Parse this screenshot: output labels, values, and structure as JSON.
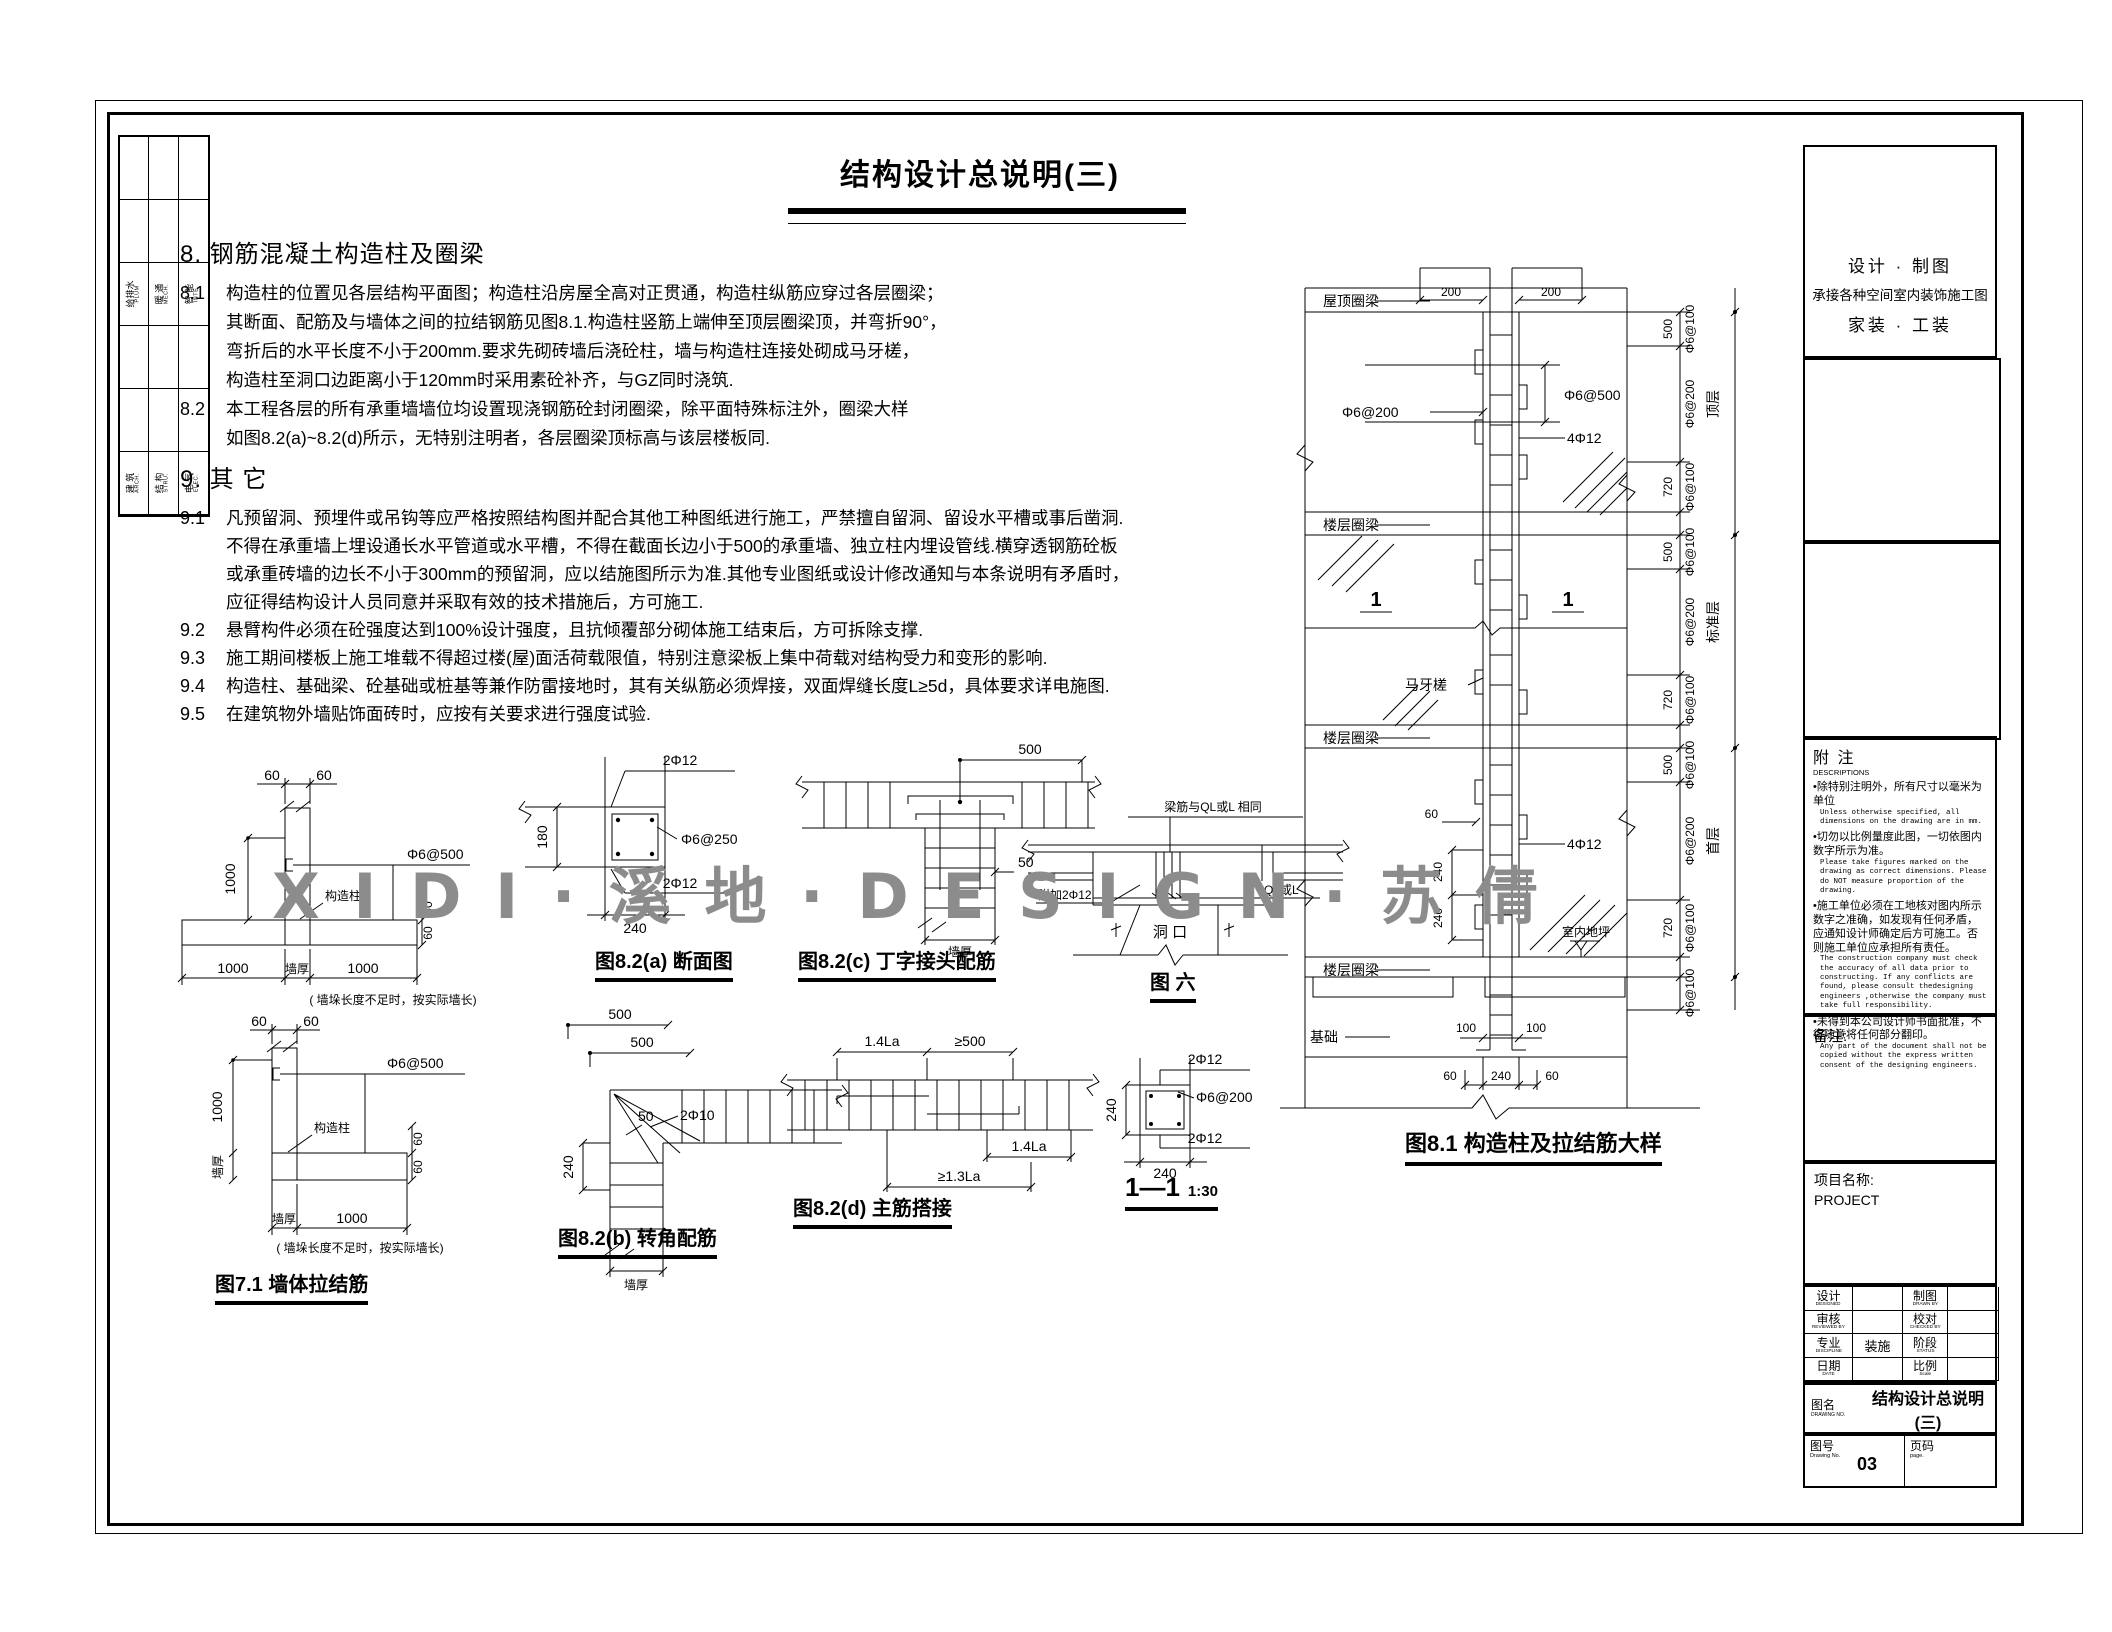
{
  "sheet": {
    "title": "结构设计总说明(三)",
    "watermark": "X I D I · 溪 地 · D E S I G N · 苏 倩"
  },
  "edge_strip": {
    "upper": [
      {
        "cn": "给排水",
        "en": "PLUM"
      },
      {
        "cn": "暖 通",
        "en": "MECH."
      },
      {
        "cn": "智 能",
        "en": "INTE."
      }
    ],
    "lower": [
      {
        "cn": "建 筑",
        "en": "ARCH."
      },
      {
        "cn": "结 构",
        "en": "STRU."
      },
      {
        "cn": "电 气",
        "en": "ELEC."
      }
    ]
  },
  "notes": {
    "s8_heading": "8.  钢筋混凝土构造柱及圈梁",
    "items8": [
      {
        "num": "8.1",
        "lines": [
          "构造柱的位置见各层结构平面图；构造柱沿房屋全高对正贯通，构造柱纵筋应穿过各层圈梁；",
          "其断面、配筋及与墙体之间的拉结钢筋见图8.1.构造柱竖筋上端伸至顶层圈梁顶，并弯折90°，",
          "弯折后的水平长度不小于200mm.要求先砌砖墙后浇砼柱，墙与构造柱连接处砌成马牙槎，",
          "构造柱至洞口边距离小于120mm时采用素砼补齐，与GZ同时浇筑."
        ]
      },
      {
        "num": "8.2",
        "lines": [
          "本工程各层的所有承重墙墙位均设置现浇钢筋砼封闭圈梁，除平面特殊标注外，圈梁大样",
          "如图8.2(a)~8.2(d)所示，无特别注明者，各层圈梁顶标高与该层楼板同."
        ]
      }
    ],
    "s9_heading": "9.  其 它",
    "items9": [
      {
        "num": "9.1",
        "lines": [
          "凡预留洞、预埋件或吊钩等应严格按照结构图并配合其他工种图纸进行施工，严禁擅自留洞、留设水平槽或事后凿洞.",
          "不得在承重墙上埋设通长水平管道或水平槽，不得在截面长边小于500的承重墙、独立柱内埋设管线.横穿透钢筋砼板",
          "或承重砖墙的边长不小于300mm的预留洞，应以结施图所示为准.其他专业图纸或设计修改通知与本条说明有矛盾时，",
          "应征得结构设计人员同意并采取有效的技术措施后，方可施工."
        ]
      },
      {
        "num": "9.2",
        "lines": [
          "悬臂构件必须在砼强度达到100%设计强度，且抗倾覆部分砌体施工结束后，方可拆除支撑."
        ]
      },
      {
        "num": "9.3",
        "lines": [
          "施工期间楼板上施工堆载不得超过楼(屋)面活荷载限值，特别注意梁板上集中荷载对结构受力和变形的影响."
        ]
      },
      {
        "num": "9.4",
        "lines": [
          "构造柱、基础梁、砼基础或桩基等兼作防雷接地时，其有关纵筋必须焊接，双面焊缝长度L≥5d，具体要求详电施图."
        ]
      },
      {
        "num": "9.5",
        "lines": [
          "在建筑物外墙贴饰面砖时，应按有关要求进行强度试验."
        ]
      }
    ]
  },
  "fig71": {
    "caption": "图7.1 墙体拉结筋",
    "note": "( 墙垛长度不足时，按实际墙长)",
    "t": {
      "d60a": "60",
      "d60b": "60",
      "d1000": "1000",
      "tie": "Φ6@500",
      "col": "构造柱",
      "d60c": "60",
      "d60d": "60",
      "w1000l": "1000",
      "wall": "墙厚",
      "w1000r": "1000"
    },
    "l": {
      "d60a": "60",
      "d60b": "60",
      "d1000": "1000",
      "wallv": "墙厚",
      "tie": "Φ6@500",
      "col": "构造柱",
      "d60c": "60",
      "d60d": "60",
      "wall": "墙厚",
      "w1000": "1000"
    }
  },
  "fig82a": {
    "caption": "图8.2(a) 断面图",
    "top": "2Φ12",
    "mid": "Φ6@250",
    "bot": "2Φ12",
    "w": "240",
    "h": "180"
  },
  "fig82b": {
    "caption": "图8.2(b) 转角配筋",
    "d500a": "500",
    "d500b": "500",
    "d240": "240",
    "d50": "50",
    "bars": "2Φ10",
    "wall": "墙厚"
  },
  "fig82c": {
    "caption": "图8.2(c) 丁字接头配筋",
    "d500": "500",
    "d50": "50",
    "wall": "墙厚"
  },
  "fig82d": {
    "caption": "图8.2(d) 主筋搭接",
    "la1": "1.4La",
    "d500": "≥500",
    "la2": "1.4La",
    "la3": "≥1.3La"
  },
  "fig6": {
    "caption": "图 六",
    "beam": "梁筋与QL或L 相同",
    "extra": "附加2Φ12",
    "hole": "洞 口",
    "ql": "QL或L"
  },
  "sec11": {
    "caption": "1—1",
    "scale": "1:30",
    "top": "2Φ12",
    "mid": "Φ6@200",
    "bot": "2Φ12",
    "w": "240",
    "h": "240"
  },
  "fig81": {
    "caption": "图8.1 构造柱及拉结筋大样",
    "roof": "屋顶圈梁",
    "floor1": "楼层圈梁",
    "floor2": "楼层圈梁",
    "floor3": "楼层圈梁",
    "base": "基础",
    "ground": "室内地坪",
    "tooth": "马牙槎",
    "tie200": "Φ6@200",
    "tie500": "Φ6@500",
    "bars1": "4Φ12",
    "bars2": "4Φ12",
    "d200a": "200",
    "d200b": "200",
    "d60": "60",
    "d240a": "240",
    "d240b": "240",
    "d100a": "100",
    "d100b": "100",
    "b60a": "60",
    "b240": "240",
    "b60b": "60",
    "seca": "1",
    "secb": "1",
    "chain": [
      {
        "len": "500",
        "tie": "Φ6@100"
      },
      {
        "tie": "Φ6@200",
        "storey": "顶层"
      },
      {
        "len": "720",
        "tie": "Φ6@100"
      },
      {
        "len": "500",
        "tie": "Φ6@100"
      },
      {
        "tie": "Φ6@200",
        "storey": "标准层"
      },
      {
        "len": "720",
        "tie": "Φ6@100"
      },
      {
        "len": "500",
        "tie": "Φ6@100"
      },
      {
        "tie": "Φ6@200",
        "storey": "首层"
      },
      {
        "len": "720",
        "tie": "Φ6@100"
      },
      {
        "tie": "Φ6@100"
      }
    ]
  },
  "titleblock": {
    "co1": "设计  ·  制图",
    "co2": "承接各种空间室内装饰施工图",
    "co3": "家装  ·  工装",
    "notes_cn": "附 注",
    "notes_en": "DESCRIPTIONS",
    "bullets": [
      {
        "cn": "•除特别注明外，所有尺寸以毫米为单位",
        "en": "Unless otherwise specified, all dimensions on the drawing are in mm."
      },
      {
        "cn": "•切勿以比例量度此图，一切依图内数字所示为准。",
        "en": "Please take figures marked on the drawing as correct dimensions. Please do NOT measure proportion of the drawing."
      },
      {
        "cn": "•施工单位必须在工地核对图内所示数字之准确，如发现有任何矛盾，应通知设计师确定后方可施工。否则施工单位应承担所有责任。",
        "en": "The construction company must check the accuracy of all data prior to constructing. If any conflicts are found, please consult thedesigning engineers ,otherwise the company must take full responsibility."
      },
      {
        "cn": "•未得到本公司设计师书面批准，不得随意将任何部分翻印。",
        "en": "Any part of the document shall not be copied without the express written consent of the designing engineers."
      }
    ],
    "remark": "备注:",
    "project_label": "项目名称:",
    "project": "PROJECT",
    "rows": [
      {
        "l1": "设计",
        "e1": "DESIGNED",
        "v1": "",
        "l2": "制图",
        "e2": "DRAWN BY",
        "v2": ""
      },
      {
        "l1": "审核",
        "e1": "REVIEWED BY",
        "v1": "",
        "l2": "校对",
        "e2": "CHECKED BY",
        "v2": ""
      },
      {
        "l1": "专业",
        "e1": "DISCIPLINE",
        "v1": "装施",
        "l2": "阶段",
        "e2": "STATUS",
        "v2": ""
      },
      {
        "l1": "日期",
        "e1": "DATE",
        "v1": "",
        "l2": "比例",
        "e2": "Scale",
        "v2": ""
      }
    ],
    "figname_l": "图名",
    "figname_e": "DRAWING NO.",
    "figname": "结构设计总说明(三)",
    "figno_l": "图号",
    "figno_e": "Drawing No.",
    "figno": "03",
    "page_l": "页码",
    "page_e": "page."
  }
}
